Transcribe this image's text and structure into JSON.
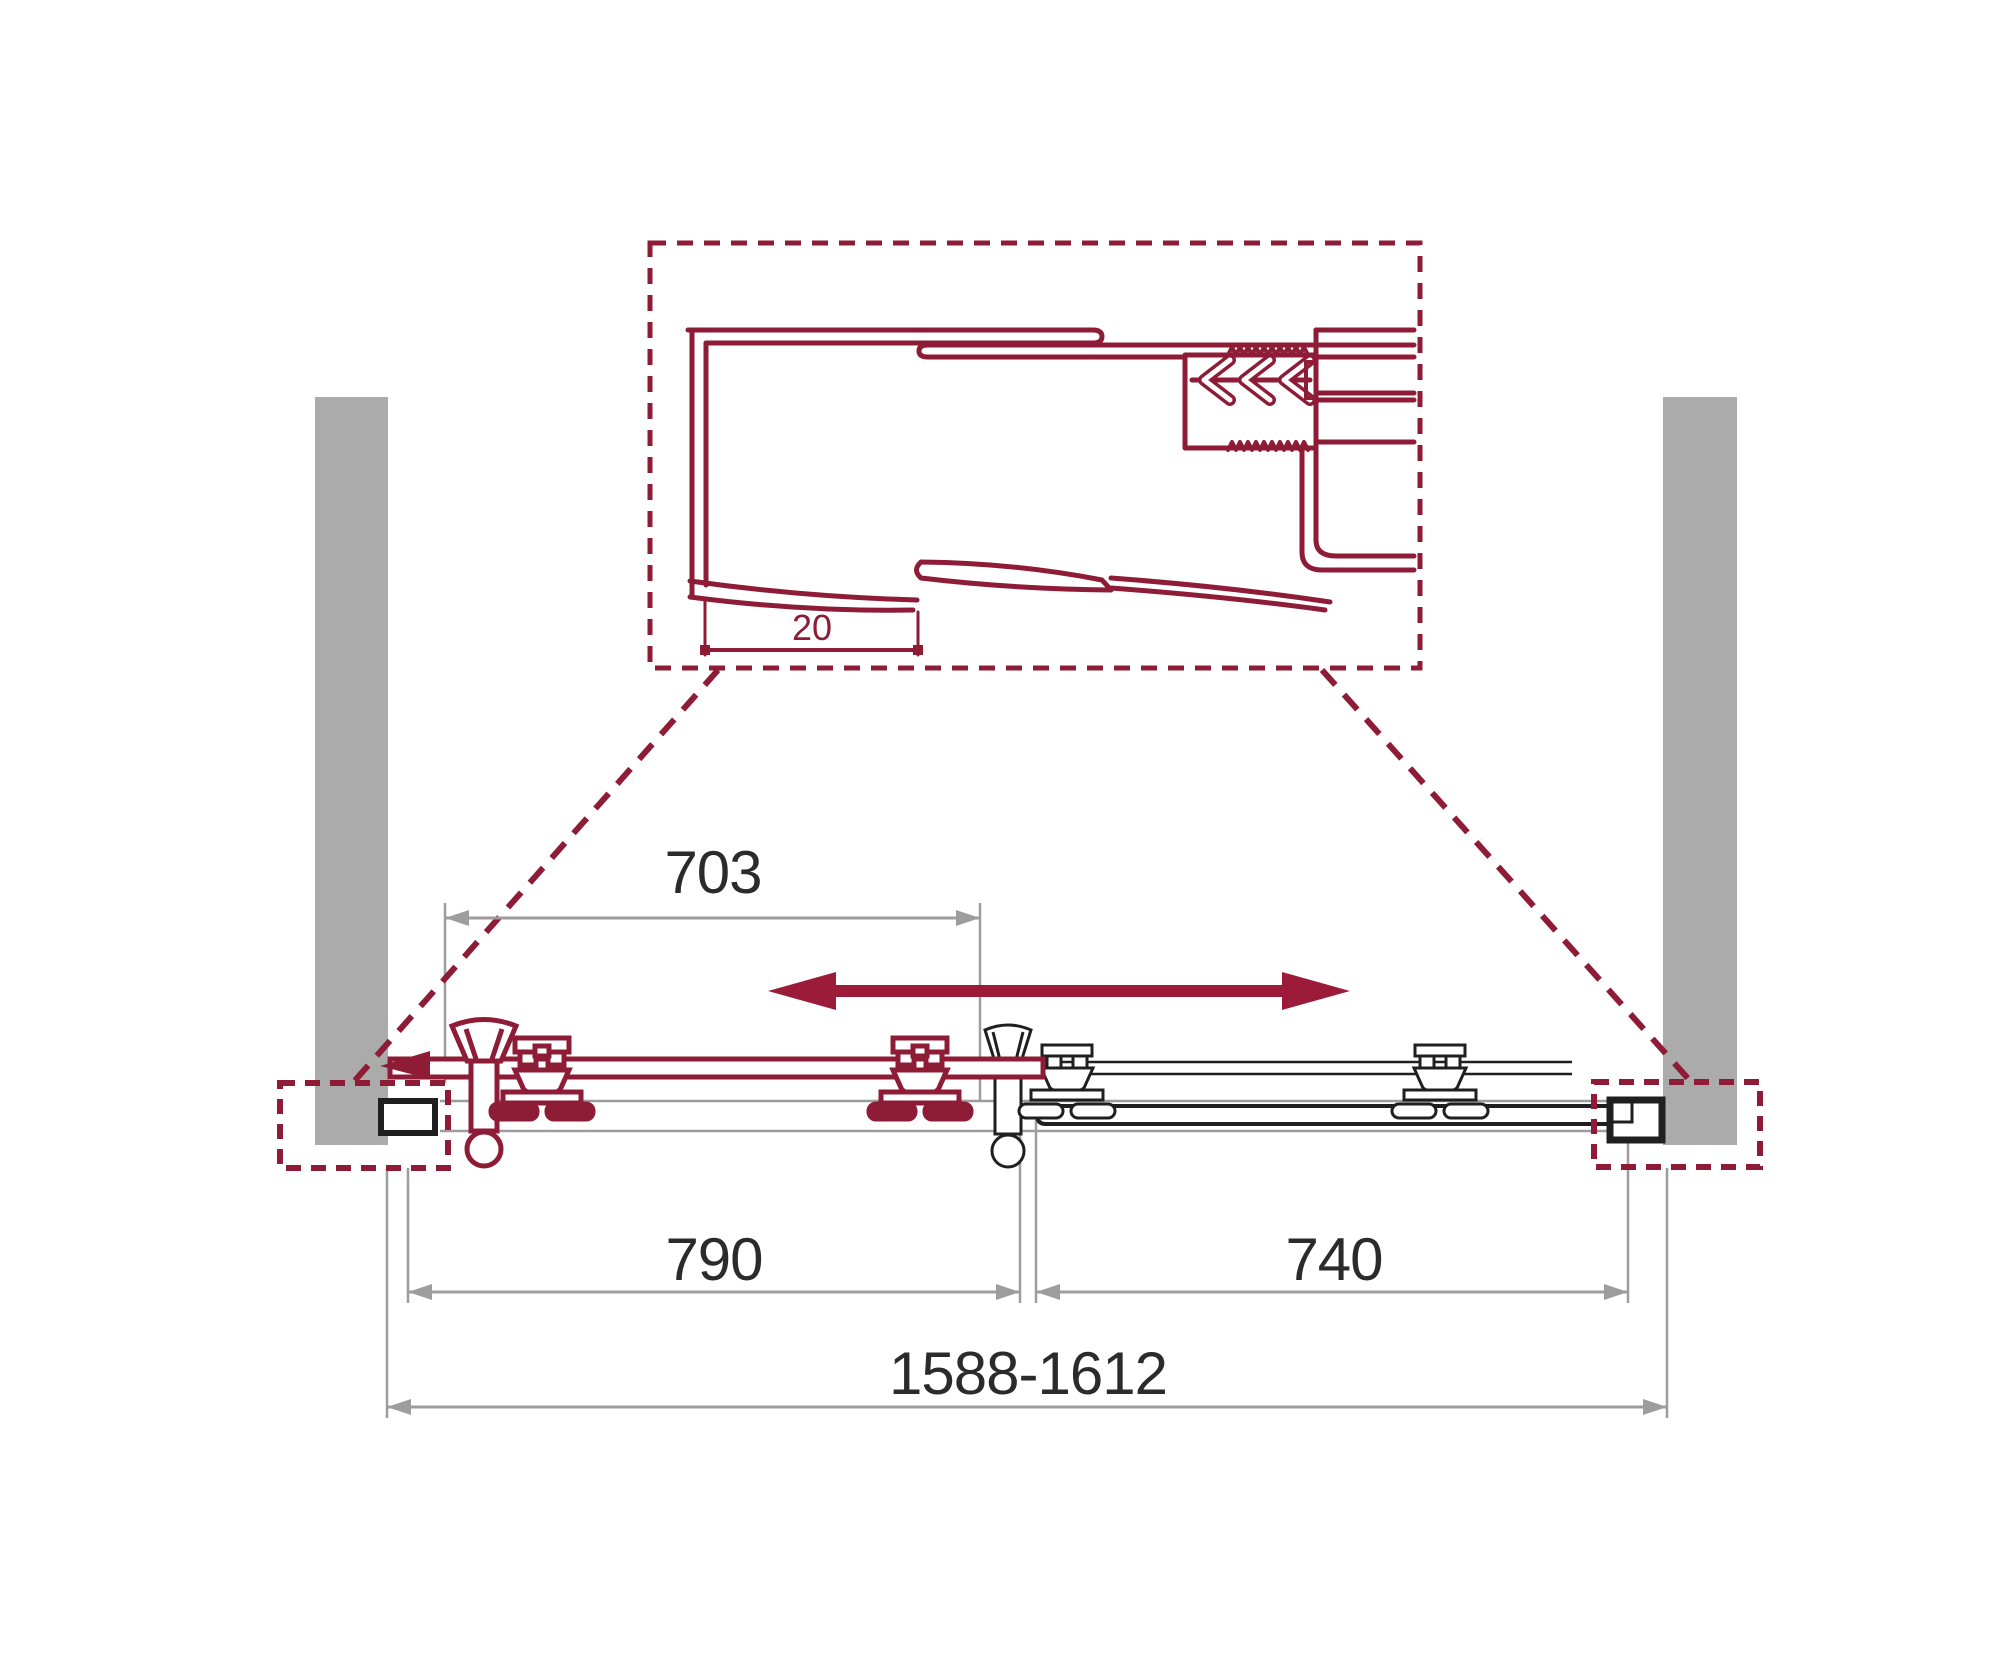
{
  "page": {
    "description": "Technical installation diagram of a sliding shower door, top view, with zoom detail of wall profile"
  },
  "colors": {
    "accent_red": "#8E1C36",
    "arrow_red": "#9B1B38",
    "wall_gray": "#ABABAB",
    "dimension_gray": "#9D9D9D",
    "line_black": "#1F1F1F",
    "text_dark": "#2B2B2B",
    "background": "#FFFFFF"
  },
  "detail_view": {
    "profile_gap_dimension": "20"
  },
  "dimensions": {
    "door_opening_top": "703",
    "left_door": "790",
    "right_panel": "740",
    "overall_range": "1588-1612"
  }
}
